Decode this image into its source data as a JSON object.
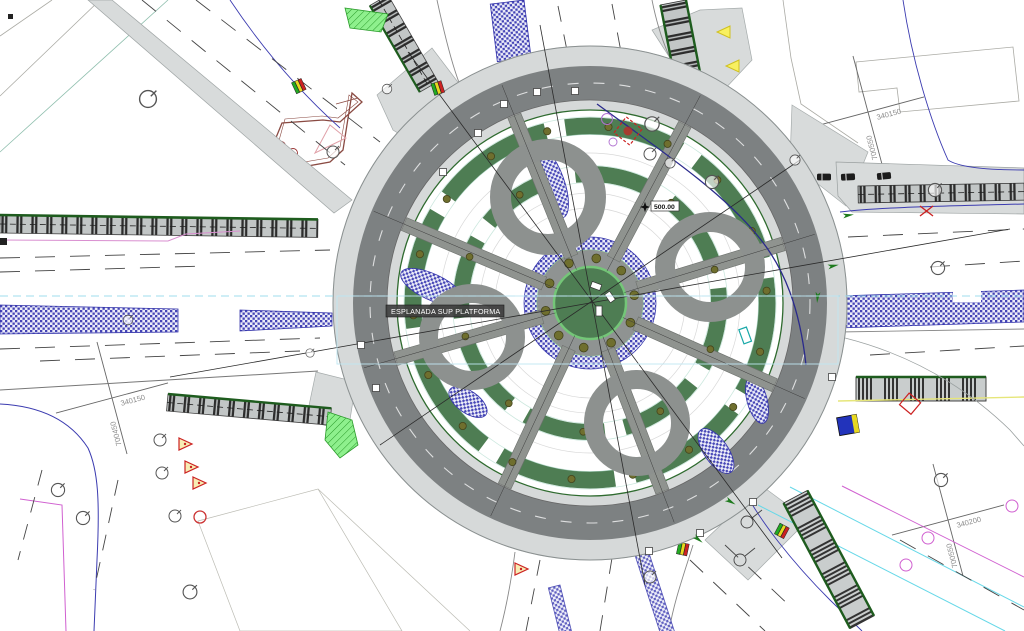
{
  "drawing": {
    "type": "roundabout-site-plan",
    "labels": {
      "platform": "ESPLANADA SUP PLATFORMA",
      "spot_elevation": "500.00"
    },
    "grid_crosses": [
      {
        "position": "top-right",
        "northing": "700550",
        "easting": "340150"
      },
      {
        "position": "bottom-left",
        "northing": "700450",
        "easting": "340150"
      },
      {
        "position": "bottom-right",
        "northing": "700550",
        "easting": "340200"
      }
    ],
    "legend_colors": {
      "carriageway": "#7d8182",
      "sidewalk_apron": "#d6d9d9",
      "canopy_gray": "#8d918f",
      "landscape_green": "#4e7d53",
      "green_edge": "#1e5c1e",
      "paving_hatch_blue": "#4444b6",
      "guide_cyan": "#9fdcec",
      "utility_magenta": "#d060d0",
      "signal_green": "#22aa22",
      "signal_yellow": "#e8d820",
      "signal_red": "#cc2222"
    }
  }
}
